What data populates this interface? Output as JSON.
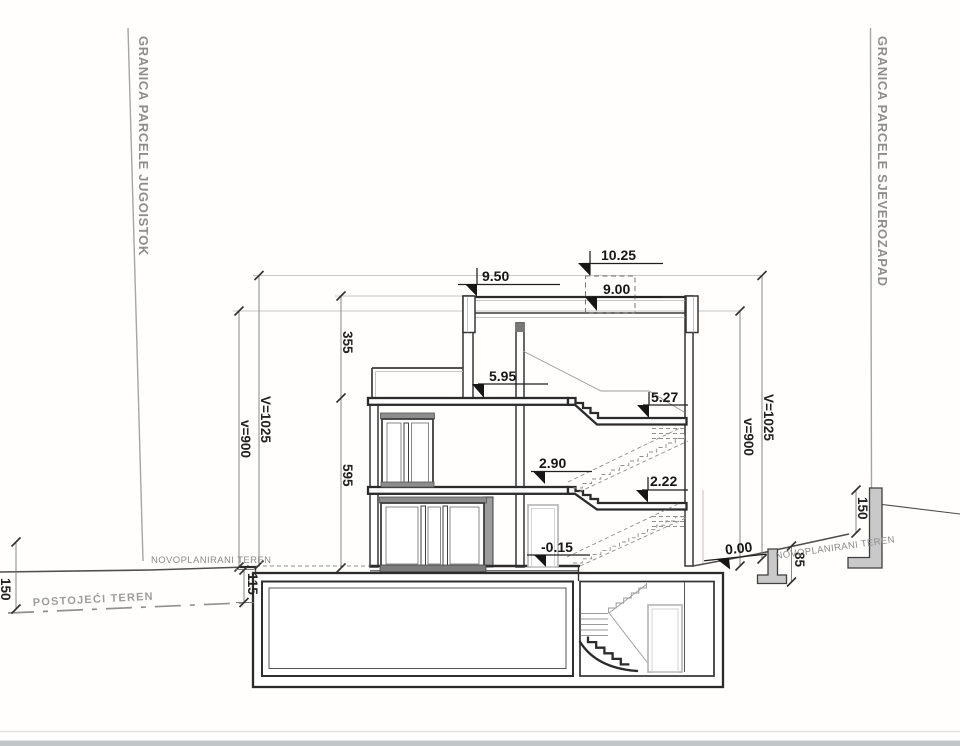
{
  "boundaries": {
    "left_label": "GRANICA PARCELE JUGOISTOK",
    "right_label": "GRANICA PARCELE SJEVEROZAPAD"
  },
  "terrain": {
    "new_left": "NOVOPLANIRANI TEREN",
    "new_right": "NOVOPLANIRANI TEREN",
    "existing": "POSTOJEĆI TEREN"
  },
  "levels": {
    "parapet": "10.25",
    "roof_edge": "9.50",
    "roof": "9.00",
    "top_floor": "5.95",
    "landing_upper": "5.27",
    "first_floor": "2.90",
    "landing_lower": "2.22",
    "ground_floor": "-0.15",
    "site_zero": "0.00"
  },
  "dims": {
    "v_total": "V=1025",
    "v_roof": "v=900",
    "upper": "355",
    "lower": "595",
    "left_terrain_drop": "115",
    "left_edge_drop": "150",
    "right_wall_height": "150",
    "right_terrain_step": "85"
  }
}
